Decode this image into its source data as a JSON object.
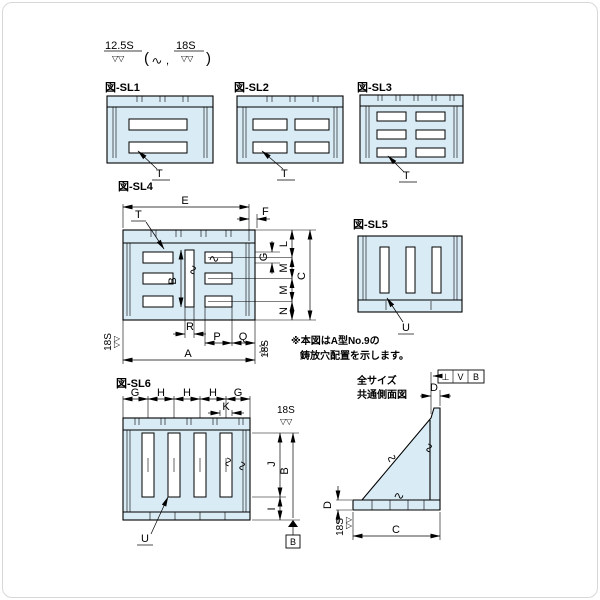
{
  "symbols": {
    "triangles": "▽▽"
  },
  "finish_note": {
    "rough": "12.5S",
    "open": "(",
    "comma": ",",
    "fine": "18S",
    "close": ")"
  },
  "sl1": {
    "label": "図-SL1",
    "t": "T"
  },
  "sl2": {
    "label": "図-SL2",
    "t": "T"
  },
  "sl3": {
    "label": "図-SL3",
    "t": "T"
  },
  "sl4": {
    "label": "図-SL4",
    "e": "E",
    "f": "F",
    "t": "T",
    "b": "B",
    "r": "R",
    "p": "P",
    "q": "Q",
    "a": "A",
    "l": "L",
    "g": "G",
    "m1": "M",
    "m2": "M",
    "n": "N",
    "c": "C",
    "finish_left": "18S",
    "finish_right": "18S"
  },
  "sl5": {
    "label": "図-SL5",
    "u": "U"
  },
  "sl6": {
    "label": "図-SL6",
    "g1": "G",
    "h1": "H",
    "h2": "H",
    "h3": "H",
    "g2": "G",
    "k": "K",
    "j": "J",
    "i": "I",
    "b": "B",
    "u": "U",
    "finish": "18S",
    "datum": "B"
  },
  "note": {
    "line1": "※本図はA型No.9の",
    "line2": "鋳放穴配置を示します。"
  },
  "side": {
    "title1": "全サイズ",
    "title2": "共通側面図",
    "d_top": "D",
    "d_left": "D",
    "c": "C",
    "finish": "18S",
    "fcf_symbol": "⊥",
    "fcf_tolerance": "V",
    "fcf_datum": "B"
  }
}
